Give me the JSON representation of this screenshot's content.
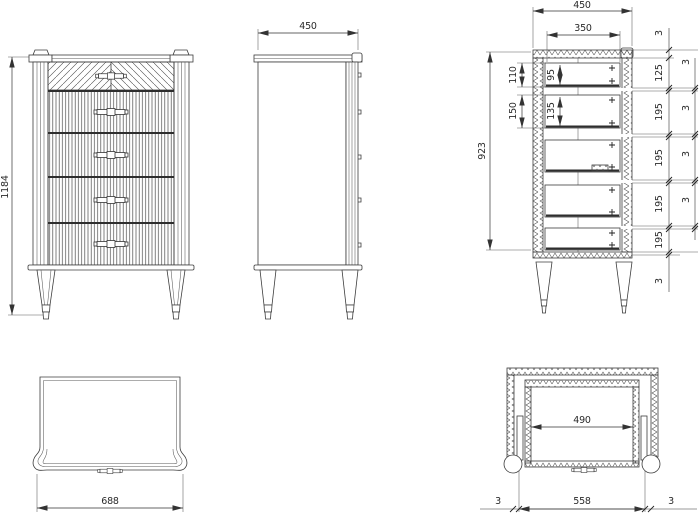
{
  "drawing": {
    "views": {
      "front": {
        "height": "1184"
      },
      "side": {
        "depth": "450"
      },
      "section": {
        "depth": "450",
        "inner_depth": "350",
        "height": "923",
        "drawer1_box": "110",
        "drawer2_box": "150",
        "drawer1_inner": "95",
        "drawer2_inner": "135",
        "front_stack": [
          "3",
          "125",
          "195",
          "195",
          "195",
          "195",
          "3"
        ],
        "front_gaps": [
          "3",
          "3",
          "3",
          "3"
        ]
      },
      "top": {
        "width": "688"
      },
      "plan": {
        "inner_width": "490",
        "bottom": [
          "3",
          "558",
          "3"
        ]
      }
    },
    "line_color": "#3c3c3c",
    "background": "#ffffff"
  }
}
